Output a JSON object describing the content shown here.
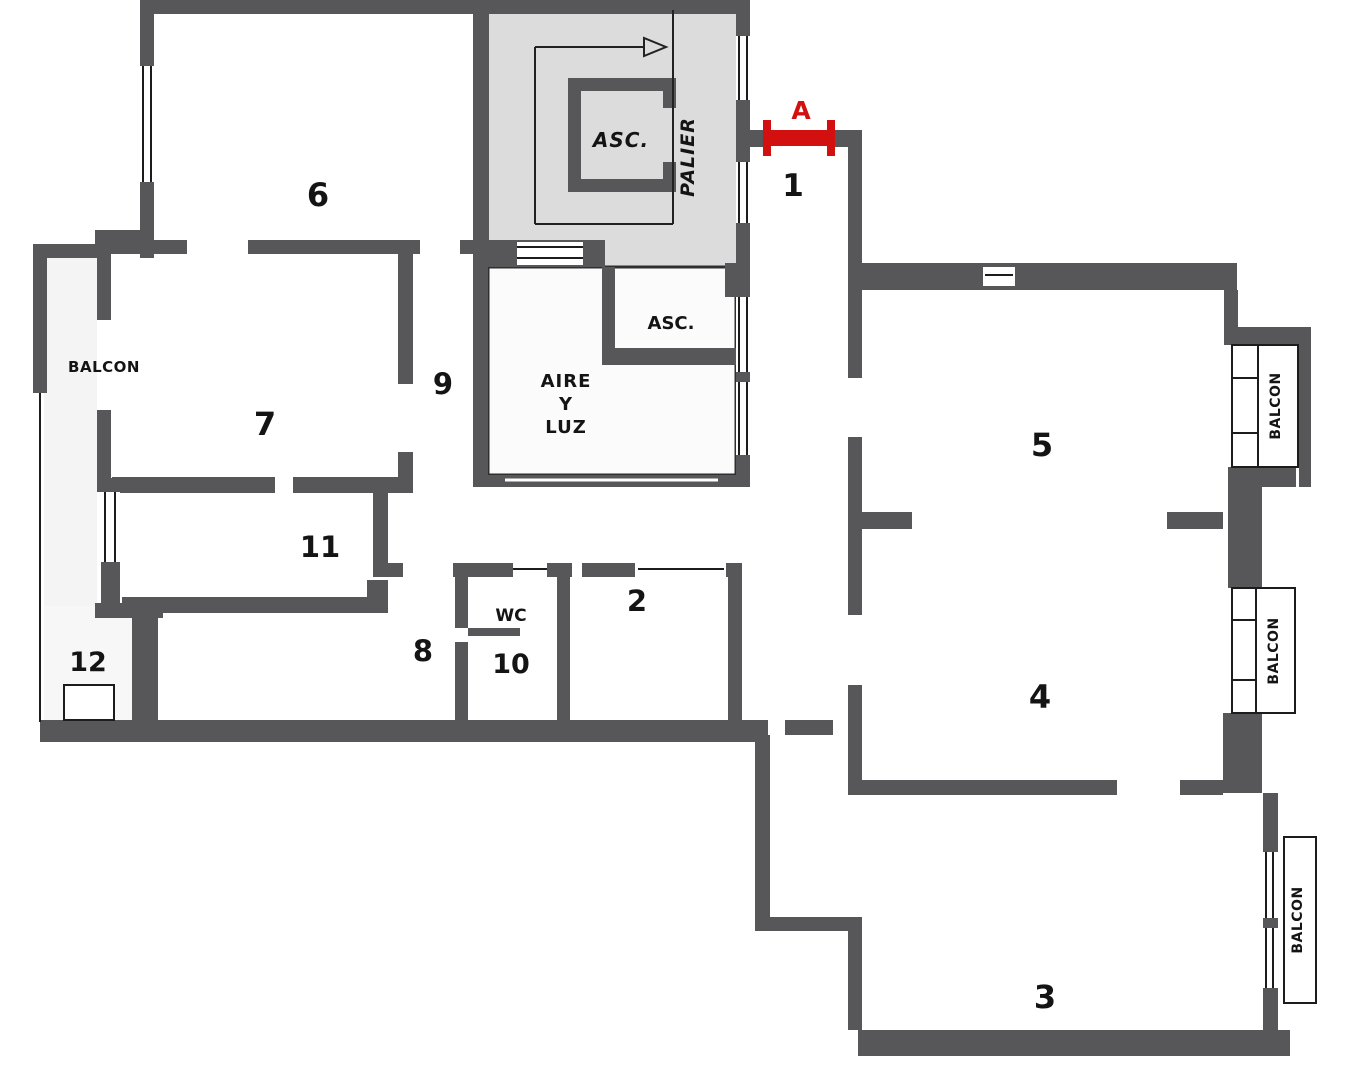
{
  "plan": {
    "entrance_marker": "A",
    "rooms": [
      {
        "number": "1"
      },
      {
        "number": "2"
      },
      {
        "number": "3"
      },
      {
        "number": "4"
      },
      {
        "number": "5"
      },
      {
        "number": "6"
      },
      {
        "number": "7"
      },
      {
        "number": "8"
      },
      {
        "number": "9"
      },
      {
        "number": "10"
      },
      {
        "number": "11"
      },
      {
        "number": "12"
      }
    ],
    "labels": {
      "balcony_left": "BALCON",
      "balcony_right_top": "BALCON",
      "balcony_right_middle": "BALCON",
      "balcony_right_bottom": "BALCON",
      "elevator_main": "ASC.",
      "elevator_secondary": "ASC.",
      "landing": "PALIER",
      "lightwell_line1": "AIRE",
      "lightwell_line2": "Y",
      "lightwell_line3": "LUZ",
      "wc": "WC"
    },
    "colors": {
      "wall": "#57575a",
      "stair_fill": "#dcdcdc",
      "balcony_fill": "#f4f4f4",
      "entrance_red": "#d31010"
    }
  }
}
